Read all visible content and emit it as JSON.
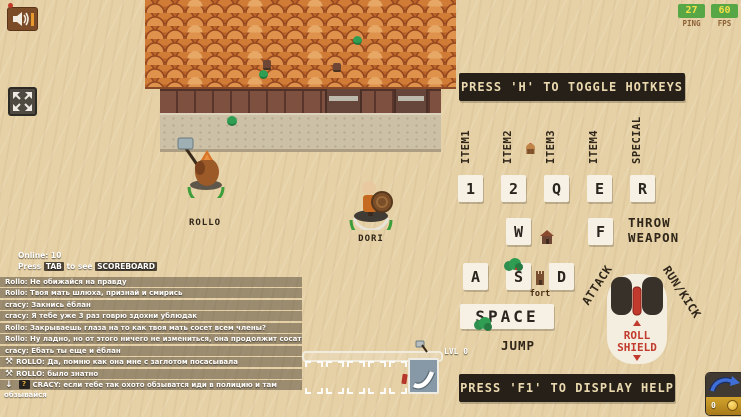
{
  "colors": {
    "sand": "#e6d1a6",
    "panel_dark": "#262019",
    "panel_text": "#ead9ae",
    "key_bg": "#f6f1e4",
    "key_text": "#2b2520",
    "accent_red": "#c13a2d",
    "badge_green": "#57a746",
    "badge_text": "#f7e04b",
    "slot_blue": "#8799a7",
    "coin_gold": "#e9b83a",
    "roof_orange": "#d07b36",
    "label_brown": "#2f2619"
  },
  "hud": {
    "ping_value": "27",
    "ping_label": "PING",
    "fps_value": "60",
    "fps_label": "FPS",
    "coin_count": "0"
  },
  "banners": {
    "toggle_hotkeys": "PRESS 'H' TO TOGGLE HOTKEYS",
    "display_help": "PRESS 'F1' TO DISPLAY HELP"
  },
  "hotkeys": {
    "item_labels": [
      "ITEM1",
      "ITEM2",
      "ITEM3",
      "ITEM4",
      "SPECIAL"
    ],
    "row1_keys": [
      "1",
      "2",
      "Q",
      "E",
      "R"
    ],
    "w_key": "W",
    "f_key": "F",
    "throw_line1": "THROW",
    "throw_line2": "WEAPON",
    "row3_keys": [
      "A",
      "S",
      "D"
    ],
    "fort_label": "fort",
    "space_key": "SPACE",
    "jump_label": "JUMP",
    "attack_label": "ATTACK",
    "runkick_label": "RUN/KICK",
    "roll_line1": "ROLL",
    "roll_line2": "SHIELD"
  },
  "players": [
    {
      "name": "ROLLO"
    },
    {
      "name": "DORI"
    }
  ],
  "status": {
    "online": "Online: 10",
    "hint_prefix": "Press",
    "hint_key": "TAB",
    "hint_middle": "to see",
    "hint_target": "SCOREBOARD"
  },
  "level": {
    "label": "LVL 0"
  },
  "icons": {
    "axe_glyph": "⚒",
    "down_arrow_glyph": "↓",
    "question_glyph": "?"
  },
  "chat": {
    "messages": [
      {
        "text": "Rollo: Не обижайся на правду"
      },
      {
        "text": "Rollo: Твоя мать шлюха, признай и смирись"
      },
      {
        "text": "cracy: Закнись ёблан"
      },
      {
        "text": "cracy: Я тебе уже 3 раз говрю здохни ублюдак"
      },
      {
        "text": "Rollo: Закрываешь глаза на то как твоя мать сосет всем члены?"
      },
      {
        "text": "Rollo: Ну ладно, но от этого ничего не измениться, она продолжит сосать"
      },
      {
        "text": "cracy: Ебать ты еще и ёблан"
      },
      {
        "text": "ROLLO: Да, помню как она мне с заглотом посасывала"
      },
      {
        "text": "ROLLO: было знатно"
      },
      {
        "text": "CRACY: если тебе так охото обзыватся иди в полицию и там",
        "text_wrap": "обзывайся"
      }
    ]
  }
}
